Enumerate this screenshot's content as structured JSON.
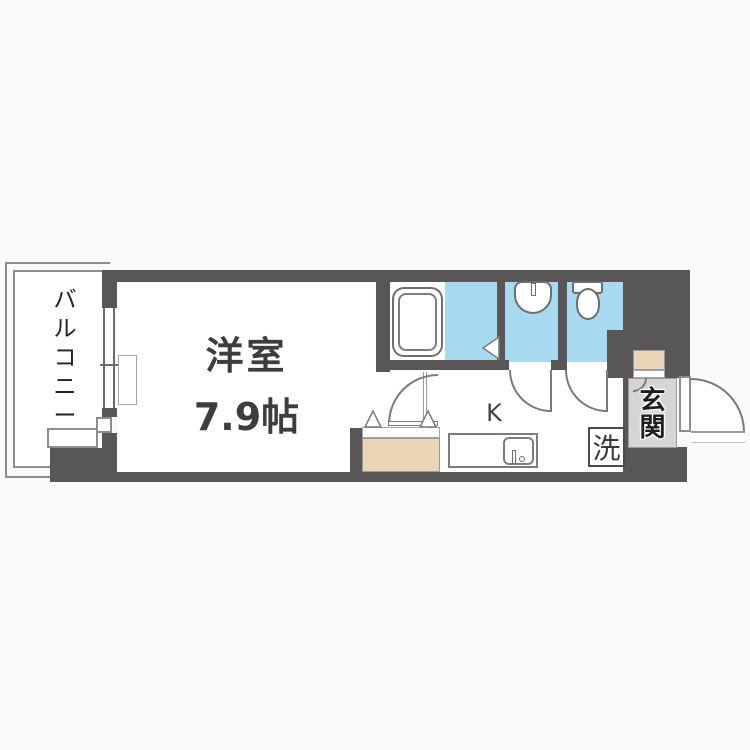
{
  "floorplan": {
    "balcony": {
      "label": "バルコニー",
      "chars": [
        "バ",
        "ル",
        "コ",
        "ニ",
        "ー"
      ]
    },
    "main_room": {
      "label": "洋室",
      "size": "7.9帖"
    },
    "kitchen": {
      "label": "K"
    },
    "laundry": {
      "label": "洗"
    },
    "entrance": {
      "label": "玄関",
      "chars": [
        "玄",
        "関"
      ]
    },
    "fixtures": [
      "bathtub",
      "washbasin",
      "toilet",
      "kitchen-sink",
      "kitchen-counter",
      "closet",
      "shoe-cabinet",
      "window",
      "front-door",
      "washing-machine-space"
    ],
    "colors": {
      "wall": "#585656",
      "water": "#a7daf1",
      "storage": "#ead6b6",
      "entrance_floor": "#d5d5d5"
    }
  }
}
